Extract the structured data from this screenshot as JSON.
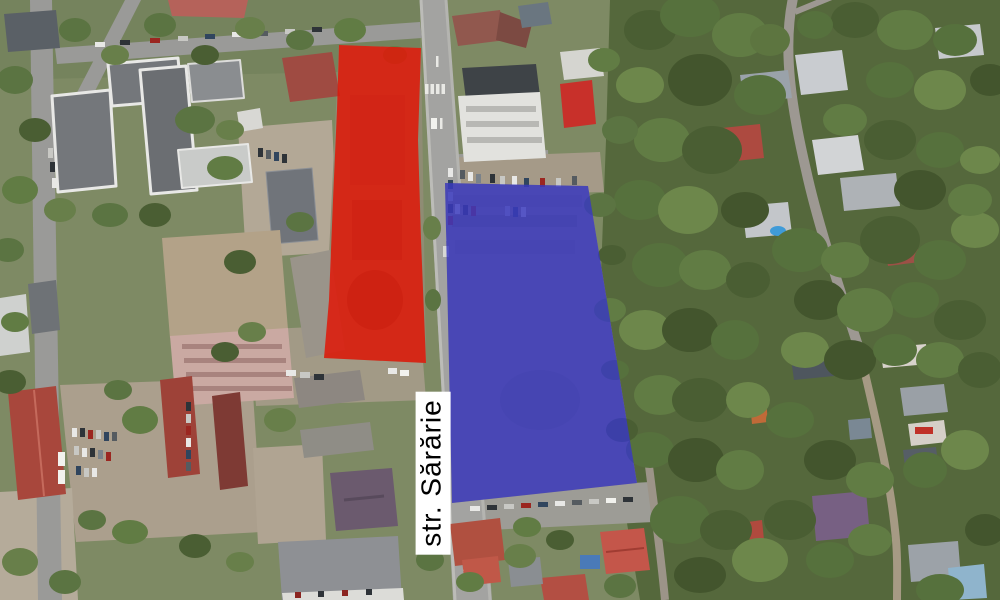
{
  "map": {
    "street_label": "str. Sărărie",
    "label_style": {
      "background": "#ffffff",
      "text_color": "#000000"
    },
    "zones": {
      "red": {
        "color": "#e01708",
        "side": "west of street"
      },
      "blue": {
        "color": "#3939bf",
        "side": "east of street"
      }
    }
  }
}
